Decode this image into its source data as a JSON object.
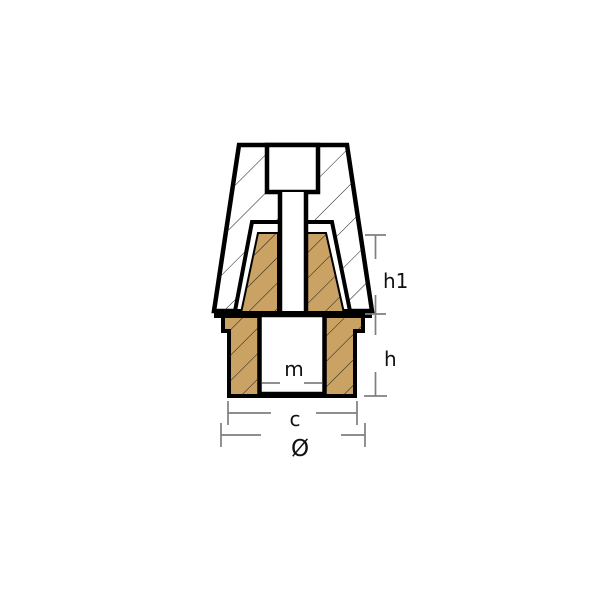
{
  "drawing": {
    "title": "anode-cross-section",
    "labels": {
      "h1": "h1",
      "h": "h",
      "m": "m",
      "c": "c",
      "diameter": "Ø"
    }
  },
  "colors": {
    "background": "#ffffff",
    "outline": "#000000",
    "brass": "#c9a264",
    "zinc": "#ffffff",
    "hatch": "#1a1a1a",
    "dimension_line": "#7f7f7f",
    "label_text": "#111111"
  }
}
